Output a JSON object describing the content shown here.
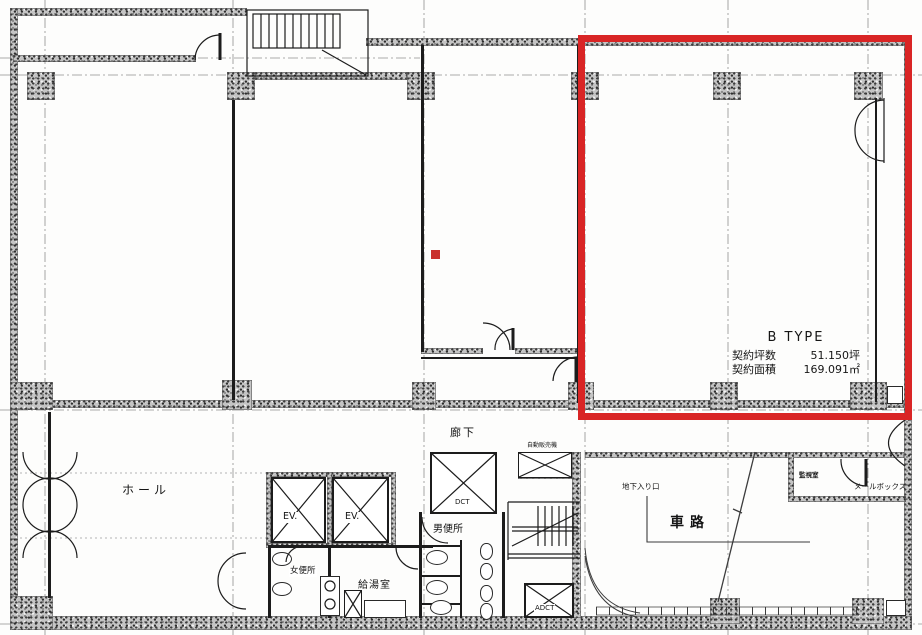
{
  "plan": {
    "unit": {
      "name": "B TYPE",
      "tsubo_label": "契約坪数",
      "tsubo_value": "51.150坪",
      "area_label": "契約面積",
      "area_value": "169.091㎡"
    },
    "rooms": {
      "hall": "ホール",
      "corridor": "廊下",
      "elevator_1": "EV.",
      "elevator_2": "EV.",
      "duct": "DCT",
      "adct": "ADCT",
      "mens_toilet": "男便所",
      "womens_toilet": "女便所",
      "kitchenette": "給湯室",
      "vending_machine": "自動販売機",
      "basement_entrance": "地下入り口",
      "driveway": "車路",
      "monitor_room": "監視室",
      "mailbox": "メールボックス"
    },
    "colors": {
      "highlight": "#d92525",
      "marker": "#c9302c",
      "wall_fill": "#c4c4c4",
      "line": "#1c1c1c",
      "grid": "#8a8a8a"
    }
  }
}
